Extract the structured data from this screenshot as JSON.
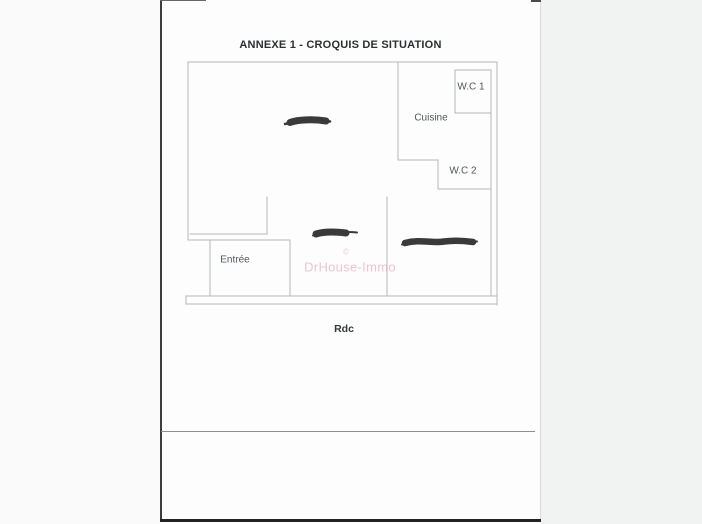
{
  "page": {
    "title": "ANNEXE 1 - CROQUIS DE SITUATION",
    "floor_label": "Rdc"
  },
  "plan": {
    "rooms": [
      {
        "label": "W.C 1"
      },
      {
        "label": "Cuisine"
      },
      {
        "label": "W.C 2"
      },
      {
        "label": "Entrée"
      }
    ],
    "redaction_marks": 3
  },
  "watermark": {
    "symbol": "©",
    "text": "DrHouse-Immo"
  },
  "colors": {
    "wall": "#b3b6b9",
    "redaction": "#2e2e30",
    "watermark_pink": "#e2a3af",
    "page_background": "#fdfdfd",
    "scan_edge_dark": "#232325",
    "scan_line_gray": "#8f8f91"
  }
}
